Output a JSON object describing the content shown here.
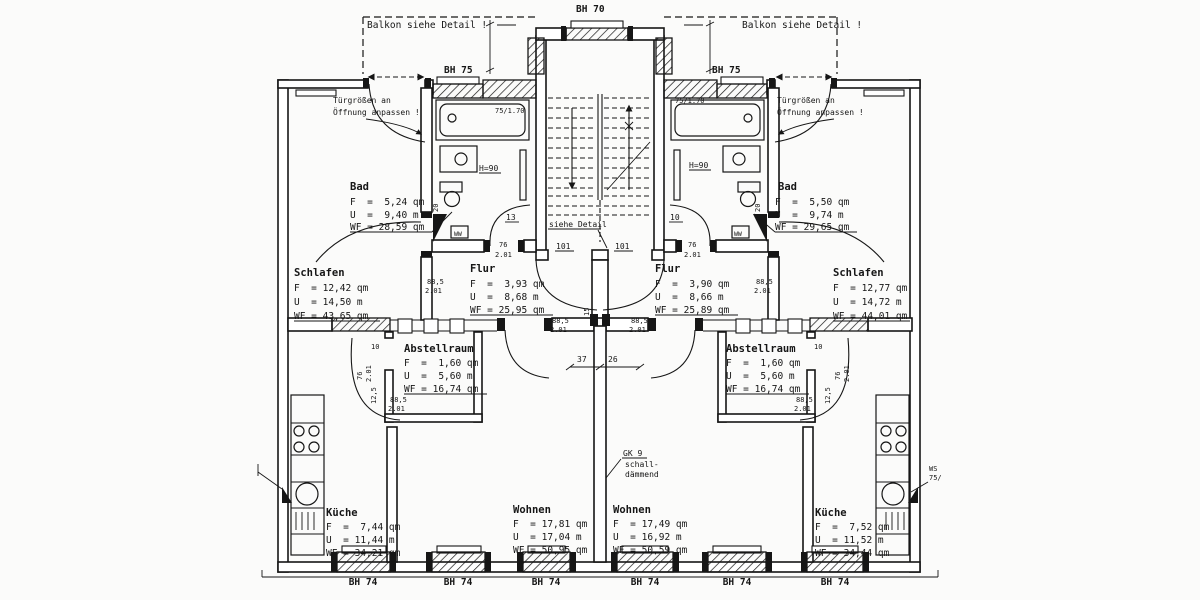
{
  "plan": {
    "rooms": {
      "schlafen_l": {
        "n": "Schlafen",
        "f": "F  = 12,42 qm",
        "u": "U  = 14,50 m",
        "wf": "WF = 43,65 qm"
      },
      "schlafen_r": {
        "n": "Schlafen",
        "f": "F  = 12,77 qm",
        "u": "U  = 14,72 m",
        "wf": "WF = 44,01 qm"
      },
      "bad_l": {
        "n": "Bad",
        "f": "F  =  5,24 qm",
        "u": "U  =  9,40 m",
        "wf": "WF = 28,59 qm"
      },
      "bad_r": {
        "n": "Bad",
        "f": "F  =  5,50 qm",
        "u": "U  =  9,74 m",
        "wf": "WF = 29,65 qm"
      },
      "flur_l": {
        "n": "Flur",
        "f": "F  =  3,93 qm",
        "u": "U  =  8,68 m",
        "wf": "WF = 25,95 qm"
      },
      "flur_r": {
        "n": "Flur",
        "f": "F  =  3,90 qm",
        "u": "U  =  8,66 m",
        "wf": "WF = 25,89 qm"
      },
      "abstell_l": {
        "n": "Abstellraum",
        "f": "F  =  1,60 qm",
        "u": "U  =  5,60 m",
        "wf": "WF = 16,74 qm"
      },
      "abstell_r": {
        "n": "Abstellraum",
        "f": "F  =  1,60 qm",
        "u": "U  =  5,60 m",
        "wf": "WF = 16,74 qm"
      },
      "kueche_l": {
        "n": "Küche",
        "f": "F  =  7,44 qm",
        "u": "U  = 11,44 m",
        "wf": "WF = 34,21 qm"
      },
      "kueche_r": {
        "n": "Küche",
        "f": "F  =  7,52 qm",
        "u": "U  = 11,52 m",
        "wf": "WF = 34,44 qm"
      },
      "wohnen_l": {
        "n": "Wohnen",
        "f": "F  = 17,81 qm",
        "u": "U  = 17,04 m",
        "wf": "WF = 50,95 qm"
      },
      "wohnen_r": {
        "n": "Wohnen",
        "f": "F  = 17,49 qm",
        "u": "U  = 16,92 m",
        "wf": "WF = 50,59 qm"
      }
    },
    "annotations": {
      "balkon": "Balkon siehe Detail !",
      "tuer1": "Türgrößen an",
      "tuer2": "Öffnung anpassen !",
      "siehe": "siehe Detail",
      "gk1": "GK 9",
      "gk2": "schall-",
      "gk3": "dämmend",
      "ws1": "WS",
      "ws2": "75/"
    },
    "windows": {
      "bh70": "BH 70",
      "bh75": "BH 75",
      "bh74": "BH 74"
    },
    "dims": {
      "d101": "101",
      "d7517": "75/1.70",
      "d76": "76",
      "d201": "2.01",
      "d885": "88,5",
      "d13": "13",
      "d10": "10",
      "d20": "20",
      "d125": "12,5",
      "d37": "37",
      "d26": "26",
      "d15": "15",
      "h90": "H=90",
      "ww": "WW"
    }
  }
}
